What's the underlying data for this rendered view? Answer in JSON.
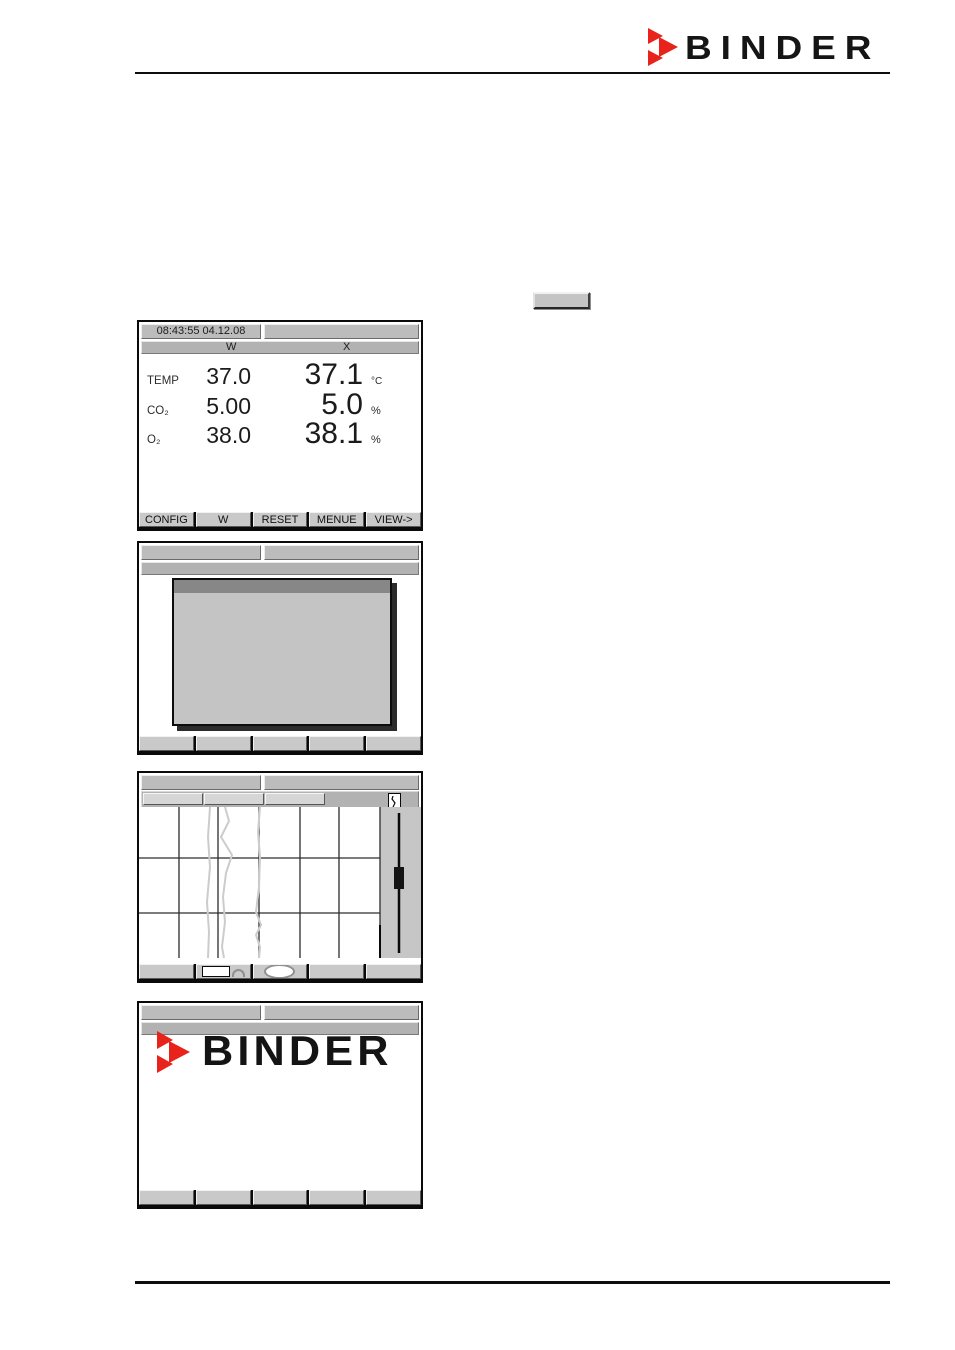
{
  "colors": {
    "brand_red": "#e8231c",
    "bar_gray": "#bcbcbc",
    "softkey_gray": "#c9c9c9",
    "dialog_body_gray": "#c4c4c4",
    "dialog_title_gray": "#878787",
    "trace_gray": "#cccccc",
    "screen_border": "#0a0a0a"
  },
  "header": {
    "brand": "BINDER"
  },
  "screens": {
    "normal_display": {
      "time_date": "08:43:55  04.12.08",
      "col_w": "W",
      "col_x": "X",
      "rows": [
        {
          "label": "TEMP",
          "set": "37.0",
          "actual": "37.1",
          "unit": "°C"
        },
        {
          "label": "CO₂",
          "set": "5.00",
          "actual": "5.0",
          "unit": "%"
        },
        {
          "label": "O₂",
          "set": "38.0",
          "actual": "38.1",
          "unit": "%"
        }
      ],
      "softkeys": [
        "CONFIG",
        "W",
        "RESET",
        "MENUE",
        "VIEW->"
      ]
    },
    "splash": {
      "brand": "BINDER"
    }
  }
}
